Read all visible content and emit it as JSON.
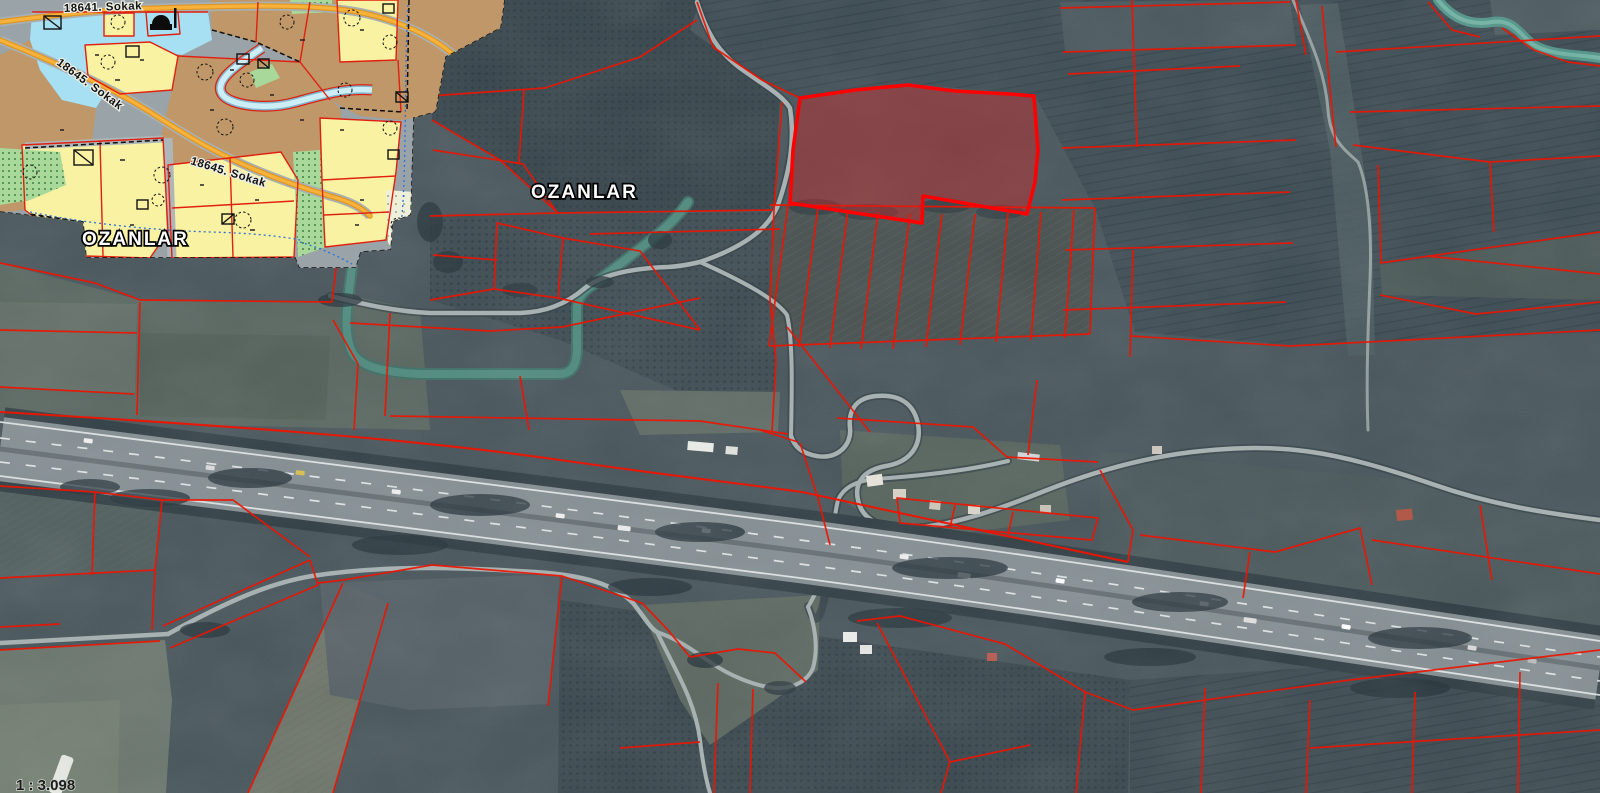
{
  "labels": {
    "street_18641": "18641. Sokak",
    "street_18645_a": "18645. Sokak",
    "street_18645_b": "18645. Sokak",
    "place_ozanlar_west": "OZANLAR",
    "place_ozanlar_east": "OZANLAR",
    "scale_ratio": "1 : 3.098"
  },
  "colors": {
    "cadastral_line": "#ee1400",
    "selected_parcel_border": "#ff0000",
    "selected_parcel_fill": "#e02020",
    "zoning_yellow": "#f8f2a2",
    "zoning_brown": "#bf9768",
    "zoning_water_blue": "#a6e0f2",
    "zoning_green": "#a8d99a",
    "zoning_cream": "#eef0da",
    "zoning_road_orange": "#f2a531",
    "plan_base_gray": "#9aa3a7",
    "stream_teal": "#4e8a7e",
    "highway_asphalt": "#848e92"
  },
  "map": {
    "selected_parcel_highlighted": true
  }
}
